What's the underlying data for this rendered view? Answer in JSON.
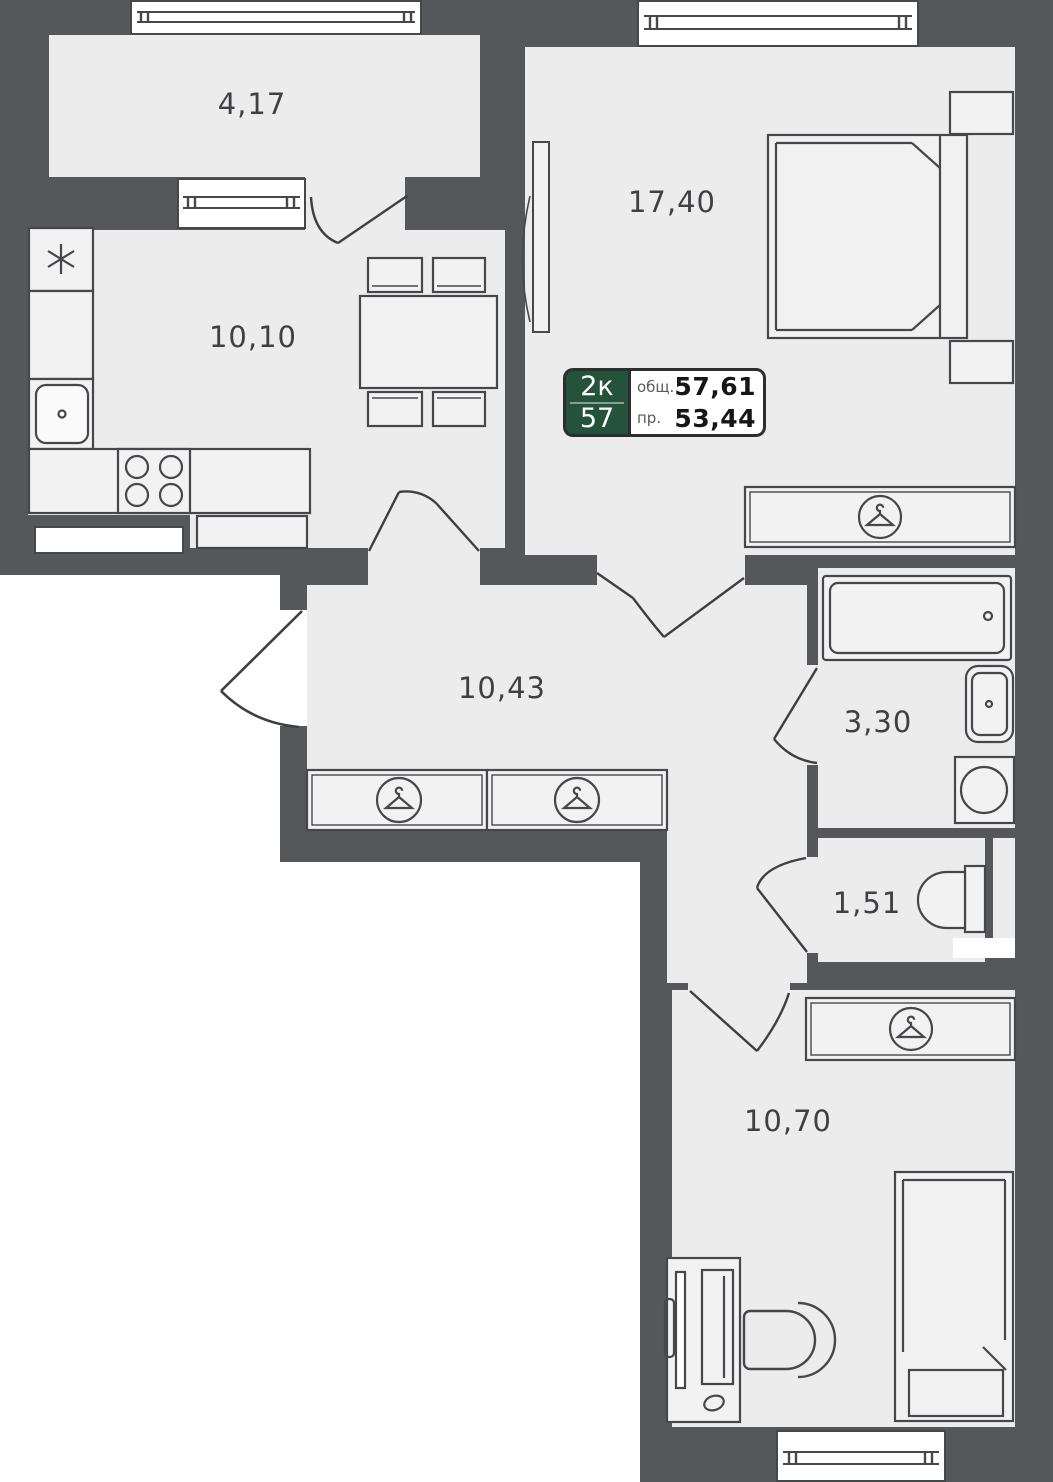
{
  "plan_title": "2-room apartment floor plan",
  "chip": {
    "type_label": "2к",
    "unit_number": "57",
    "total_label": "общ.",
    "total_value": "57,61",
    "living_label": "пр.",
    "living_value": "53,44"
  },
  "rooms": {
    "balcony": {
      "name": "balcony",
      "area": "4,17"
    },
    "kitchen": {
      "name": "kitchen",
      "area": "10,10"
    },
    "bedroom": {
      "name": "bedroom",
      "area": "17,40"
    },
    "hall": {
      "name": "hallway",
      "area": "10,43"
    },
    "bathroom": {
      "name": "bathroom",
      "area": "3,30"
    },
    "wc": {
      "name": "wc",
      "area": "1,51"
    },
    "room2": {
      "name": "room",
      "area": "10,70"
    }
  },
  "icons": {
    "hanger": "hanger-in-circle-icon (wardrobe)",
    "fridge": "snowflake-asterisk-icon (fridge)",
    "stove": "four-burner-stove-icon",
    "sink": "sink-basin-icon",
    "bathtub": "bathtub-icon",
    "washer": "washing-machine-icon",
    "toilet": "toilet-icon",
    "bed": "double-bed-icon",
    "desk": "desk-with-monitor-icon",
    "chair": "desk-chair-icon"
  },
  "colors": {
    "wall": "#56575a",
    "floor": "#ececec",
    "outside": "#ffffff",
    "line": "#46474a",
    "chip_green": "#24523b",
    "chip_border": "#2c2e2f",
    "label_text": "#3f4043"
  }
}
